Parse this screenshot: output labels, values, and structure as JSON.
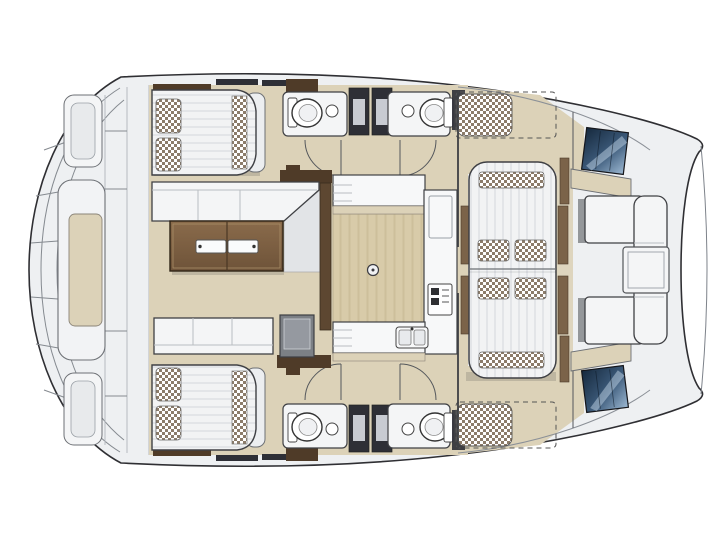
{
  "figure": {
    "type": "floorplan",
    "subject": "Catamaran yacht deck and accommodation plan",
    "view": "top-down",
    "orientation": "bow on the right, stern on the left",
    "text_labels": []
  },
  "colors": {
    "outline": "#3f4044",
    "hull-stroke": "#2f2f33",
    "deck": "#eef0f2",
    "interior-floor": "#dcd2b8",
    "wood-floor": "#d8cba9",
    "wood-grain": "#cdbf9b",
    "counter": "#f7f8f9",
    "cushion": "#f2f3f4",
    "cushion-stripe": "#e3e5e8",
    "checker-dark": "#8c7c6a",
    "table-brown-light": "#8a6b4b",
    "table-brown-dark": "#6e5339",
    "dark-brown": "#4f3b28",
    "rail-brown": "#7b6349",
    "window-dark": "#2e2f36",
    "window-light": "#c8cbd2",
    "hatch-blue-deep": "#16293d",
    "hatch-blue-mid": "#3c5a7a",
    "hatch-blue-light": "#9db9d3",
    "module-grey": "#7c8085",
    "arc-stroke": "#55585c",
    "shadow": "rgba(40,40,45,0.16)"
  },
  "components": {
    "stern": [
      "aft-platform",
      "port-swim-step",
      "starboard-swim-step",
      "aft-bench-pod"
    ],
    "port-hull": [
      "aft-cabin-double-bed",
      "bathroom-with-toilet-and-sink",
      "hull-windows",
      "forepeak-berth"
    ],
    "starboard-hull": [
      "aft-cabin-double-bed",
      "bathroom-with-toilet-and-sink",
      "hull-windows",
      "forepeak-berth"
    ],
    "salon": [
      "dinette-sofa",
      "dinette-table-with-trays",
      "aft-sofa",
      "storage-module",
      "wardrobe-panels"
    ],
    "galley": [
      "aft-counter",
      "side-counter-with-fridge",
      "stove",
      "forward-counter-with-double-sink",
      "wood-floor",
      "floor-hatch"
    ],
    "foredeck": [
      "twin-sunbed-loungers",
      "forward-cockpit-c-bench",
      "forward-cockpit-table",
      "port-deck-hatch",
      "starboard-deck-hatch",
      "bow-tips"
    ]
  }
}
